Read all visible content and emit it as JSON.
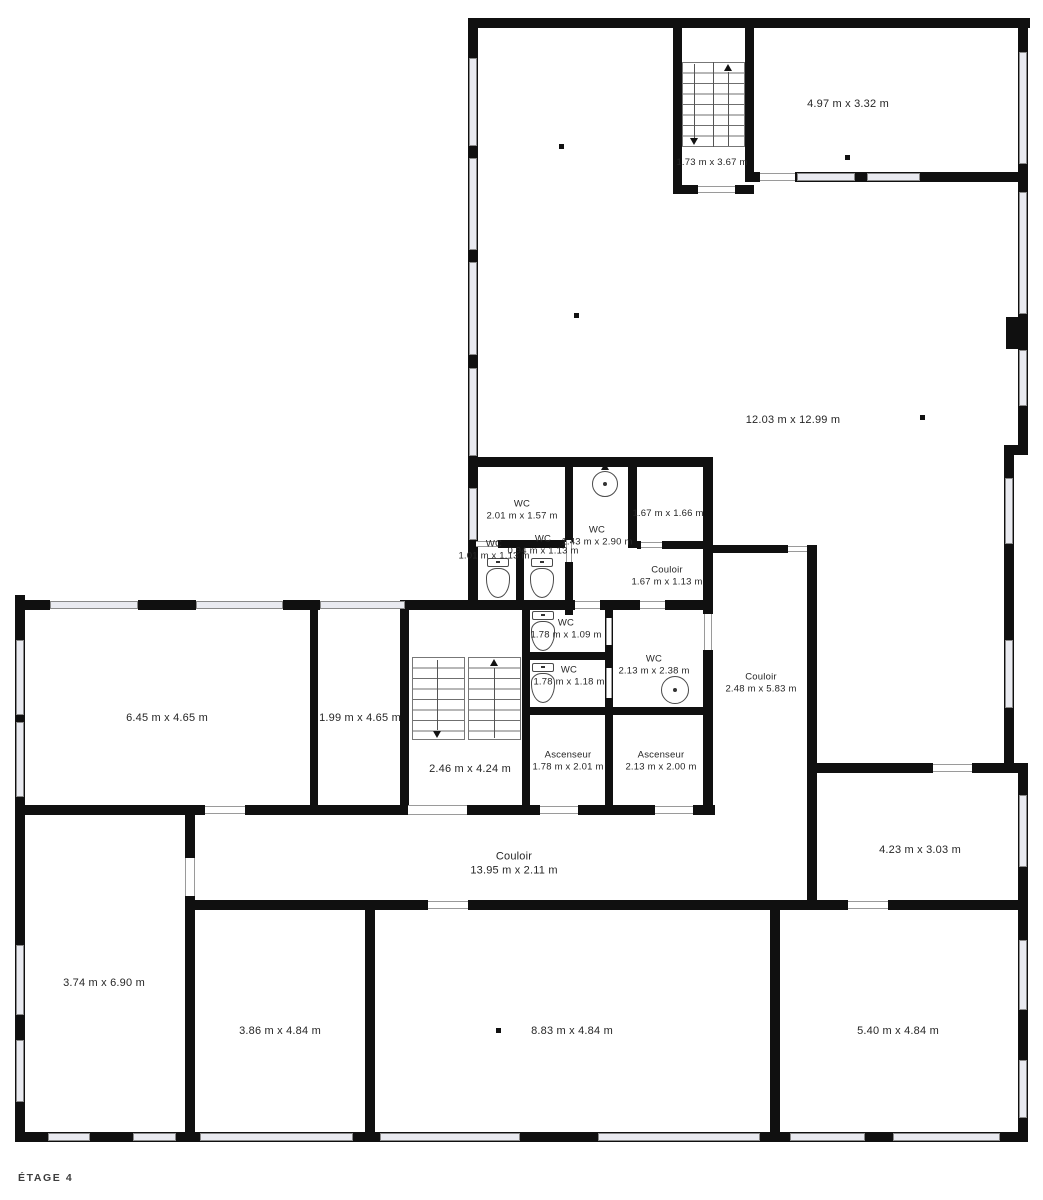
{
  "title": "ÉTAGE 4",
  "plan": {
    "type": "floor-plan",
    "language": "fr",
    "labels": [
      {
        "name": "room-4-97",
        "line1": "",
        "dims": "4.97 m x 3.32 m",
        "x": 848,
        "y": 104,
        "sm": false
      },
      {
        "name": "stairs-top",
        "line1": "",
        "dims": "1.73 m x 3.67 m",
        "x": 712,
        "y": 163,
        "sm": true
      },
      {
        "name": "room-12-03",
        "line1": "",
        "dims": "12.03 m x 12.99 m",
        "x": 793,
        "y": 420,
        "sm": false
      },
      {
        "name": "wc-2-01",
        "line1": "WC",
        "dims": "2.01 m x 1.57 m",
        "x": 522,
        "y": 511,
        "sm": true
      },
      {
        "name": "wc-1-43",
        "line1": "WC",
        "dims": "1.43 m x 2.90 m",
        "x": 597,
        "y": 537,
        "sm": true
      },
      {
        "name": "room-1-67x1-66",
        "line1": "",
        "dims": "1.67 m x 1.66 m",
        "x": 668,
        "y": 514,
        "sm": true
      },
      {
        "name": "wc-1-01",
        "line1": "WC",
        "dims": "1.01 m x 1.13 m",
        "x": 494,
        "y": 551,
        "sm": true
      },
      {
        "name": "wc-0-94",
        "line1": "WC",
        "dims": "0.94 m x 1.13 m",
        "x": 543,
        "y": 546,
        "sm": true
      },
      {
        "name": "couloir-1-67",
        "line1": "Couloir",
        "dims": "1.67 m x 1.13 m",
        "x": 667,
        "y": 577,
        "sm": true
      },
      {
        "name": "wc-1-09",
        "line1": "WC",
        "dims": "1.78 m x 1.09 m",
        "x": 566,
        "y": 630,
        "sm": true
      },
      {
        "name": "wc-1-18",
        "line1": "WC",
        "dims": "1.78 m x 1.18 m",
        "x": 569,
        "y": 677,
        "sm": true
      },
      {
        "name": "wc-2-13",
        "line1": "WC",
        "dims": "2.13 m x 2.38 m",
        "x": 654,
        "y": 666,
        "sm": true
      },
      {
        "name": "couloir-2-48",
        "line1": "Couloir",
        "dims": "2.48 m x 5.83 m",
        "x": 761,
        "y": 684,
        "sm": true
      },
      {
        "name": "room-6-45",
        "line1": "",
        "dims": "6.45 m x 4.65 m",
        "x": 167,
        "y": 718,
        "sm": false
      },
      {
        "name": "room-1-99",
        "line1": "",
        "dims": "1.99 m x 4.65 m",
        "x": 360,
        "y": 718,
        "sm": false
      },
      {
        "name": "stairs-mid",
        "line1": "",
        "dims": "2.46 m x 4.24 m",
        "x": 470,
        "y": 769,
        "sm": false
      },
      {
        "name": "ascenseur-1",
        "line1": "Ascenseur",
        "dims": "1.78 m x 2.01 m",
        "x": 568,
        "y": 762,
        "sm": true
      },
      {
        "name": "ascenseur-2",
        "line1": "Ascenseur",
        "dims": "2.13 m x 2.00 m",
        "x": 661,
        "y": 762,
        "sm": true
      },
      {
        "name": "couloir-13-95",
        "line1": "Couloir",
        "dims": "13.95 m x 2.11 m",
        "x": 514,
        "y": 864,
        "sm": false
      },
      {
        "name": "room-4-23",
        "line1": "",
        "dims": "4.23 m x 3.03 m",
        "x": 920,
        "y": 850,
        "sm": false
      },
      {
        "name": "room-3-74",
        "line1": "",
        "dims": "3.74 m x 6.90 m",
        "x": 104,
        "y": 983,
        "sm": false
      },
      {
        "name": "room-3-86",
        "line1": "",
        "dims": "3.86 m x 4.84 m",
        "x": 280,
        "y": 1031,
        "sm": false
      },
      {
        "name": "room-8-83",
        "line1": "",
        "dims": "8.83 m x 4.84 m",
        "x": 572,
        "y": 1031,
        "sm": false
      },
      {
        "name": "room-5-40",
        "line1": "",
        "dims": "5.40 m x 4.84 m",
        "x": 898,
        "y": 1031,
        "sm": false
      }
    ]
  }
}
